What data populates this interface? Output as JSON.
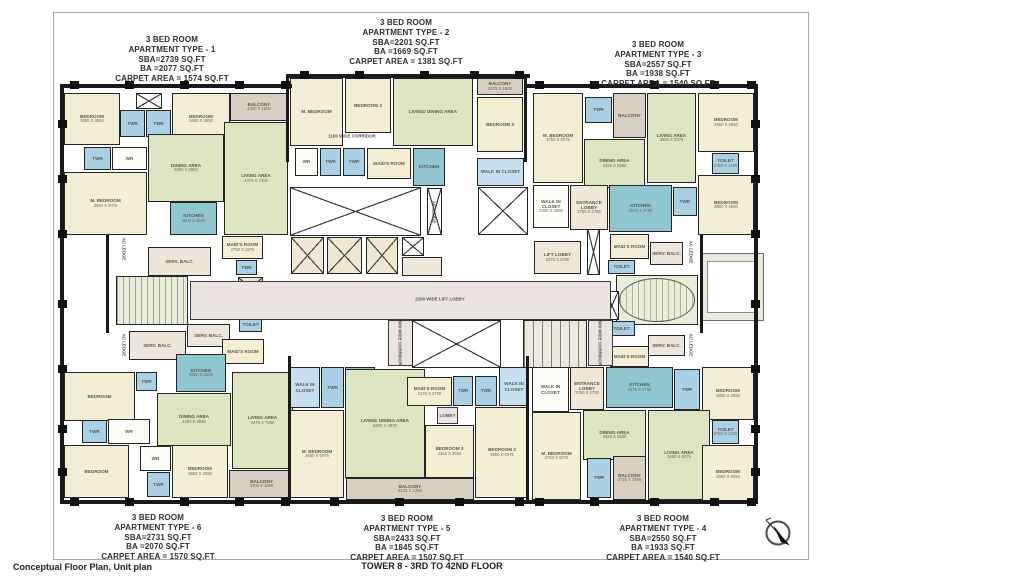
{
  "footer": {
    "left": "Conceptual Floor Plan, Unit plan",
    "center": "TOWER 8 - 3RD  TO 42ND FLOOR"
  },
  "colors": {
    "bedroom": "#f4eed5",
    "living": "#dde4c2",
    "toilet": "#a9d0e5",
    "kitchen": "#8fc6cf",
    "balcony": "#d8cec1",
    "corridor": "#ece4e1",
    "service": "#eee6da",
    "wall": "#1a1a1a"
  },
  "apartments": [
    {
      "id": "type-1",
      "x": 172,
      "y": 35,
      "lines": [
        "3 BED ROOM",
        "APARTMENT TYPE - 1",
        "SBA=2739 SQ.FT",
        "BA =2077 SQ.FT",
        "CARPET AREA = 1574 SQ.FT"
      ]
    },
    {
      "id": "type-2",
      "x": 406,
      "y": 18,
      "lines": [
        "3 BED ROOM",
        "APARTMENT TYPE - 2",
        "SBA=2201 SQ.FT",
        "BA =1669 SQ.FT",
        "CARPET AREA = 1381 SQ.FT"
      ]
    },
    {
      "id": "type-3",
      "x": 658,
      "y": 40,
      "lines": [
        "3 BED ROOM",
        "APARTMENT TYPE - 3",
        "SBA=2557 SQ.FT",
        "BA =1938 SQ.FT",
        "CARPET AREA = 1540 SQ.FT"
      ]
    },
    {
      "id": "type-6",
      "x": 158,
      "y": 513,
      "lines": [
        "3 BED ROOM",
        "APARTMENT TYPE - 6",
        "SBA=2731 SQ.FT",
        "BA =2070 SQ.FT",
        "CARPET AREA = 1570 SQ.FT"
      ]
    },
    {
      "id": "type-5",
      "x": 407,
      "y": 514,
      "lines": [
        "3 BED ROOM",
        "APARTMENT TYPE - 5",
        "SBA=2433 SQ.FT",
        "BA =1845 SQ.FT",
        "CARPET AREA = 1507 SQ.FT"
      ]
    },
    {
      "id": "type-4",
      "x": 663,
      "y": 514,
      "lines": [
        "3 BED ROOM",
        "APARTMENT TYPE - 4",
        "SBA=2550 SQ.FT",
        "BA =1933 SQ.FT",
        "CARPET AREA = 1540 SQ.FT"
      ]
    }
  ],
  "rooms": [
    {
      "type": "bed",
      "label": "BEDROOM",
      "dim": "3650 X 3650",
      "x": 64,
      "y": 93,
      "w": 56,
      "h": 52
    },
    {
      "type": "shaft",
      "x": 136,
      "y": 93,
      "w": 26,
      "h": 16
    },
    {
      "type": "wet",
      "label": "TWR",
      "x": 120,
      "y": 110,
      "w": 25,
      "h": 27
    },
    {
      "type": "wet",
      "label": "TWR",
      "x": 146,
      "y": 110,
      "w": 25,
      "h": 27
    },
    {
      "type": "bed",
      "label": "BEDROOM",
      "dim": "3650 X 3650",
      "x": 172,
      "y": 93,
      "w": 58,
      "h": 52
    },
    {
      "type": "balc",
      "label": "BALCONY",
      "dim": "4400 X 1800",
      "x": 230,
      "y": 93,
      "w": 58,
      "h": 28
    },
    {
      "type": "liv",
      "label": "LIVING AREA",
      "dim": "4475 X 7200",
      "x": 224,
      "y": 122,
      "w": 64,
      "h": 113
    },
    {
      "type": "liv",
      "label": "DINING AREA",
      "dim": "5050 X 2850",
      "x": 148,
      "y": 134,
      "w": 76,
      "h": 68
    },
    {
      "type": "wet",
      "label": "TWR",
      "x": 84,
      "y": 147,
      "w": 27,
      "h": 23
    },
    {
      "type": "wr",
      "label": "WR",
      "x": 112,
      "y": 147,
      "w": 35,
      "h": 23
    },
    {
      "type": "bed",
      "label": "M. BEDROOM",
      "dim": "3650 X 6075",
      "x": 64,
      "y": 172,
      "w": 83,
      "h": 63
    },
    {
      "type": "kit",
      "label": "KITCHEN",
      "dim": "3800 X 3525",
      "x": 170,
      "y": 202,
      "w": 47,
      "h": 33
    },
    {
      "type": "serv",
      "label": "SERV. BALC.",
      "x": 148,
      "y": 247,
      "w": 63,
      "h": 29
    },
    {
      "type": "bed",
      "label": "MAID'S ROOM",
      "dim": "2750 X 1875",
      "x": 222,
      "y": 236,
      "w": 41,
      "h": 23
    },
    {
      "type": "wet",
      "label": "TWR",
      "x": 236,
      "y": 260,
      "w": 21,
      "h": 15
    },
    {
      "type": "stair",
      "x": 116,
      "y": 276,
      "w": 72,
      "h": 49
    },
    {
      "type": "shaft",
      "x": 192,
      "y": 292,
      "w": 25,
      "h": 25
    },
    {
      "type": "lift",
      "x": 238,
      "y": 277,
      "w": 25,
      "h": 23
    },
    {
      "type": "wet",
      "label": "TOILET",
      "x": 239,
      "y": 318,
      "w": 23,
      "h": 14
    },
    {
      "type": "serv",
      "label": "SERV. BALC.",
      "x": 187,
      "y": 324,
      "w": 43,
      "h": 23
    },
    {
      "type": "serv",
      "label": "SERV. BALC.",
      "x": 129,
      "y": 331,
      "w": 57,
      "h": 29
    },
    {
      "type": "bed",
      "label": "MAID'S ROOM",
      "x": 222,
      "y": 339,
      "w": 42,
      "h": 25
    },
    {
      "type": "bed",
      "label": "BEDROOM",
      "x": 64,
      "y": 372,
      "w": 71,
      "h": 49
    },
    {
      "type": "wet",
      "label": "TWR",
      "x": 136,
      "y": 372,
      "w": 21,
      "h": 19
    },
    {
      "type": "kit",
      "label": "KITCHEN",
      "dim": "3800 X 3525",
      "x": 176,
      "y": 354,
      "w": 50,
      "h": 38
    },
    {
      "type": "liv",
      "label": "DINING AREA",
      "dim": "4400 X 2850",
      "x": 157,
      "y": 393,
      "w": 74,
      "h": 53
    },
    {
      "type": "liv",
      "label": "LIVING AREA",
      "dim": "4475 X 7200",
      "x": 232,
      "y": 372,
      "w": 61,
      "h": 97
    },
    {
      "type": "wet",
      "label": "TWR",
      "x": 82,
      "y": 420,
      "w": 25,
      "h": 23
    },
    {
      "type": "wr",
      "label": "WR",
      "x": 108,
      "y": 419,
      "w": 42,
      "h": 25
    },
    {
      "type": "bed",
      "label": "BEDROOM",
      "x": 64,
      "y": 445,
      "w": 65,
      "h": 53
    },
    {
      "type": "wr",
      "label": "WR",
      "x": 140,
      "y": 446,
      "w": 31,
      "h": 25
    },
    {
      "type": "bed",
      "label": "BEDROOM",
      "dim": "3650 X 3650",
      "x": 172,
      "y": 445,
      "w": 56,
      "h": 53
    },
    {
      "type": "wet",
      "label": "TWR",
      "x": 147,
      "y": 472,
      "w": 23,
      "h": 25
    },
    {
      "type": "balc",
      "label": "BALCONY",
      "dim": "4400 X 1800",
      "x": 229,
      "y": 470,
      "w": 65,
      "h": 28
    },
    {
      "type": "bed",
      "label": "M. BEDROOM",
      "x": 290,
      "y": 78,
      "w": 53,
      "h": 68
    },
    {
      "type": "bed",
      "label": "BEDROOM 2",
      "x": 345,
      "y": 78,
      "w": 46,
      "h": 55
    },
    {
      "type": "liv",
      "label": "LIVING/ DINING AREA",
      "x": 393,
      "y": 78,
      "w": 80,
      "h": 68
    },
    {
      "type": "balc",
      "label": "BALCONY",
      "dim": "2075 X 1800",
      "x": 477,
      "y": 78,
      "w": 46,
      "h": 17
    },
    {
      "type": "bed",
      "label": "BEDROOM 3",
      "x": 477,
      "y": 97,
      "w": 46,
      "h": 55
    },
    {
      "type": "wr",
      "label": "WR",
      "x": 295,
      "y": 148,
      "w": 23,
      "h": 28
    },
    {
      "type": "wet",
      "label": "TWR",
      "x": 320,
      "y": 148,
      "w": 21,
      "h": 28
    },
    {
      "type": "wet",
      "label": "TWR",
      "x": 343,
      "y": 148,
      "w": 22,
      "h": 28
    },
    {
      "type": "bed",
      "label": "MAID'S ROOM",
      "x": 367,
      "y": 148,
      "w": 44,
      "h": 31
    },
    {
      "type": "kit",
      "label": "KITCHEN",
      "x": 413,
      "y": 148,
      "w": 32,
      "h": 38
    },
    {
      "type": "wic",
      "label": "WALK IN CLOSET",
      "x": 477,
      "y": 158,
      "w": 47,
      "h": 28
    },
    {
      "type": "bed",
      "label": "M. BEDROOM",
      "dim": "3750 X 6075",
      "x": 533,
      "y": 93,
      "w": 50,
      "h": 90
    },
    {
      "type": "wet",
      "label": "TWR",
      "x": 585,
      "y": 97,
      "w": 27,
      "h": 26
    },
    {
      "type": "balc",
      "label": "BALCONY",
      "x": 613,
      "y": 93,
      "w": 33,
      "h": 45
    },
    {
      "type": "liv",
      "label": "LIVING AREA",
      "dim": "3650 X 6075",
      "x": 647,
      "y": 93,
      "w": 49,
      "h": 90
    },
    {
      "type": "bed",
      "label": "BEDROOM",
      "dim": "3650 X 3650",
      "x": 698,
      "y": 93,
      "w": 56,
      "h": 59
    },
    {
      "type": "liv",
      "label": "DINING AREA",
      "dim": "4025 X 2850",
      "x": 584,
      "y": 139,
      "w": 61,
      "h": 49
    },
    {
      "type": "wet",
      "label": "TOILET",
      "dim": "2750 X 1400",
      "x": 712,
      "y": 153,
      "w": 27,
      "h": 21
    },
    {
      "type": "bed",
      "label": "BEDROOM",
      "dim": "3800 X 3650",
      "x": 698,
      "y": 175,
      "w": 56,
      "h": 60
    },
    {
      "type": "wr",
      "label": "WALK IN CLOSET",
      "dim": "2300 X 3850",
      "x": 533,
      "y": 185,
      "w": 36,
      "h": 43
    },
    {
      "type": "lobby",
      "label": "ENTRANCE LOBBY",
      "dim": "2750 X 2750",
      "x": 570,
      "y": 185,
      "w": 38,
      "h": 45
    },
    {
      "type": "kit",
      "label": "KITCHEN",
      "dim": "4575 X 2750",
      "x": 609,
      "y": 185,
      "w": 63,
      "h": 47
    },
    {
      "type": "wet",
      "label": "TWR",
      "x": 673,
      "y": 187,
      "w": 24,
      "h": 29
    },
    {
      "type": "bed",
      "label": "MAID'S ROOM",
      "x": 610,
      "y": 234,
      "w": 39,
      "h": 25
    },
    {
      "type": "serv",
      "label": "SERV. BALC.",
      "x": 650,
      "y": 242,
      "w": 33,
      "h": 23
    },
    {
      "type": "wet",
      "label": "TOILET",
      "x": 608,
      "y": 260,
      "w": 27,
      "h": 14
    },
    {
      "type": "stair2",
      "x": 616,
      "y": 275,
      "w": 82,
      "h": 50
    },
    {
      "type": "shaft",
      "x": 605,
      "y": 291,
      "w": 14,
      "h": 29
    },
    {
      "type": "wet",
      "label": "TOILET",
      "x": 608,
      "y": 321,
      "w": 27,
      "h": 15
    },
    {
      "type": "serv",
      "label": "SERV. BALC.",
      "x": 648,
      "y": 335,
      "w": 37,
      "h": 21
    },
    {
      "type": "bed",
      "label": "MAID'S ROOM",
      "x": 610,
      "y": 346,
      "w": 39,
      "h": 21
    },
    {
      "type": "terr",
      "x": 700,
      "y": 253,
      "w": 64,
      "h": 68
    },
    {
      "type": "terr-in",
      "x": 707,
      "y": 261,
      "w": 50,
      "h": 52
    },
    {
      "type": "shaft",
      "x": 290,
      "y": 187,
      "w": 131,
      "h": 49
    },
    {
      "type": "shaft",
      "x": 427,
      "y": 188,
      "w": 15,
      "h": 47
    },
    {
      "type": "lift",
      "x": 291,
      "y": 237,
      "w": 33,
      "h": 37
    },
    {
      "type": "lift",
      "x": 327,
      "y": 237,
      "w": 35,
      "h": 37
    },
    {
      "type": "lift",
      "x": 366,
      "y": 237,
      "w": 32,
      "h": 37
    },
    {
      "type": "shaft",
      "x": 402,
      "y": 237,
      "w": 22,
      "h": 19
    },
    {
      "type": "lobby",
      "x": 402,
      "y": 257,
      "w": 40,
      "h": 19
    },
    {
      "type": "shaft",
      "x": 478,
      "y": 187,
      "w": 50,
      "h": 48
    },
    {
      "type": "lobby",
      "label": "LIFT LOBBY",
      "dim": "2075 X 2000",
      "x": 534,
      "y": 241,
      "w": 47,
      "h": 33
    },
    {
      "type": "shaft",
      "x": 587,
      "y": 229,
      "w": 13,
      "h": 46
    },
    {
      "type": "corr",
      "x": 190,
      "y": 281,
      "w": 421,
      "h": 39
    },
    {
      "type": "corr",
      "x": 388,
      "y": 320,
      "w": 25,
      "h": 46
    },
    {
      "type": "corr",
      "x": 588,
      "y": 320,
      "w": 25,
      "h": 46
    },
    {
      "type": "shaft",
      "x": 412,
      "y": 320,
      "w": 89,
      "h": 48
    },
    {
      "type": "duct",
      "x": 523,
      "y": 320,
      "w": 64,
      "h": 48
    },
    {
      "type": "wic",
      "label": "WALK IN CLOSET",
      "x": 290,
      "y": 367,
      "w": 30,
      "h": 41
    },
    {
      "type": "wet",
      "label": "TWR",
      "x": 321,
      "y": 367,
      "w": 23,
      "h": 41
    },
    {
      "type": "kit",
      "label": "KITCHEN",
      "x": 345,
      "y": 367,
      "w": 30,
      "h": 41
    },
    {
      "type": "bed",
      "label": "M. BEDROOM",
      "dim": "3650 X 6075",
      "x": 290,
      "y": 410,
      "w": 54,
      "h": 88
    },
    {
      "type": "liv",
      "label": "LIVING/ DINING AREA",
      "dim": "5800 X 4975",
      "x": 345,
      "y": 369,
      "w": 80,
      "h": 109
    },
    {
      "type": "bed",
      "label": "MAID'S ROOM",
      "dim": "2175 X 2700",
      "x": 407,
      "y": 377,
      "w": 45,
      "h": 29
    },
    {
      "type": "wet",
      "label": "TWR",
      "x": 453,
      "y": 376,
      "w": 20,
      "h": 30
    },
    {
      "type": "wet",
      "label": "TWR",
      "x": 475,
      "y": 376,
      "w": 22,
      "h": 30
    },
    {
      "type": "wic",
      "label": "WALK IN CLOSET",
      "x": 499,
      "y": 367,
      "w": 30,
      "h": 39
    },
    {
      "type": "corr",
      "label": "LOBBY",
      "x": 437,
      "y": 407,
      "w": 21,
      "h": 17
    },
    {
      "type": "bed",
      "label": "BEDROOM 3",
      "dim": "3250 X 3650",
      "x": 425,
      "y": 425,
      "w": 49,
      "h": 53
    },
    {
      "type": "bed",
      "label": "BEDROOM 2",
      "dim": "3650 X 6075",
      "x": 475,
      "y": 407,
      "w": 54,
      "h": 91
    },
    {
      "type": "balc",
      "label": "BALCONY",
      "dim": "6125 X 1200",
      "x": 346,
      "y": 478,
      "w": 128,
      "h": 22
    },
    {
      "type": "wr",
      "label": "WALK IN CLOSET",
      "x": 532,
      "y": 367,
      "w": 37,
      "h": 45
    },
    {
      "type": "lobby",
      "label": "ENTRANCE LOBBY",
      "dim": "2750 X 2700",
      "x": 570,
      "y": 367,
      "w": 34,
      "h": 43
    },
    {
      "type": "kit",
      "label": "KITCHEN",
      "dim": "4575 X 2750",
      "x": 606,
      "y": 367,
      "w": 67,
      "h": 41
    },
    {
      "type": "wet",
      "label": "TWR",
      "x": 674,
      "y": 369,
      "w": 26,
      "h": 41
    },
    {
      "type": "bed",
      "label": "BEDROOM",
      "dim": "3800 X 3650",
      "x": 702,
      "y": 367,
      "w": 52,
      "h": 53
    },
    {
      "type": "bed",
      "label": "M. BEDROOM",
      "dim": "3750 X 6075",
      "x": 532,
      "y": 412,
      "w": 49,
      "h": 88
    },
    {
      "type": "liv",
      "label": "DINING AREA",
      "dim": "4025 X 2850",
      "x": 583,
      "y": 410,
      "w": 63,
      "h": 50
    },
    {
      "type": "liv",
      "label": "LIVING AREA",
      "dim": "3650 X 6075",
      "x": 648,
      "y": 410,
      "w": 62,
      "h": 90
    },
    {
      "type": "wet",
      "label": "TOILET",
      "dim": "2750 X 1400",
      "x": 712,
      "y": 420,
      "w": 27,
      "h": 24
    },
    {
      "type": "bed",
      "label": "BEDROOM",
      "dim": "3650 X 3650",
      "x": 702,
      "y": 445,
      "w": 52,
      "h": 59
    },
    {
      "type": "wet",
      "label": "TWR",
      "x": 587,
      "y": 458,
      "w": 24,
      "h": 40
    },
    {
      "type": "balc",
      "label": "BALCONY",
      "dim": "2725 X 1800",
      "x": 613,
      "y": 456,
      "w": 33,
      "h": 44
    }
  ],
  "plan_labels": [
    {
      "text": "2200 WIDE LIFT LOBBY",
      "x": 440,
      "y": 299,
      "rot": 0
    },
    {
      "text": "1100 WIDE CORRIDOR",
      "x": 352,
      "y": 136,
      "rot": 0
    },
    {
      "text": "1500 WIDE CORRIDOR",
      "x": 400,
      "y": 342,
      "rot": 90
    },
    {
      "text": "1500 WIDE CORRIDOR",
      "x": 600,
      "y": 342,
      "rot": 90
    },
    {
      "text": "AC LEDGE",
      "x": 124,
      "y": 249,
      "rot": 90
    },
    {
      "text": "AC LEDGE",
      "x": 124,
      "y": 345,
      "rot": 90
    },
    {
      "text": "AC LEDGE",
      "x": 691,
      "y": 252,
      "rot": 90
    },
    {
      "text": "AC LEDGE",
      "x": 691,
      "y": 345,
      "rot": 90
    },
    {
      "text": "AC LEDGE",
      "x": 434,
      "y": 212,
      "rot": 90
    }
  ],
  "walls": [
    [
      62,
      84,
      230,
      4
    ],
    [
      286,
      74,
      244,
      4
    ],
    [
      526,
      84,
      232,
      4
    ],
    [
      62,
      500,
      696,
      4
    ],
    [
      60,
      84,
      4,
      420
    ],
    [
      754,
      84,
      4,
      420
    ],
    [
      286,
      78,
      3,
      84
    ],
    [
      524,
      78,
      3,
      84
    ],
    [
      288,
      356,
      3,
      148
    ],
    [
      526,
      356,
      3,
      148
    ],
    [
      106,
      235,
      3,
      98
    ],
    [
      700,
      235,
      3,
      98
    ]
  ],
  "columns": [
    [
      70,
      81
    ],
    [
      125,
      81
    ],
    [
      180,
      81
    ],
    [
      235,
      81
    ],
    [
      281,
      81
    ],
    [
      300,
      71
    ],
    [
      355,
      71
    ],
    [
      420,
      71
    ],
    [
      470,
      71
    ],
    [
      515,
      71
    ],
    [
      535,
      81
    ],
    [
      590,
      81
    ],
    [
      650,
      81
    ],
    [
      710,
      81
    ],
    [
      747,
      81
    ],
    [
      70,
      498
    ],
    [
      125,
      498
    ],
    [
      180,
      498
    ],
    [
      235,
      498
    ],
    [
      281,
      498
    ],
    [
      330,
      498
    ],
    [
      395,
      498
    ],
    [
      455,
      498
    ],
    [
      515,
      498
    ],
    [
      535,
      498
    ],
    [
      590,
      498
    ],
    [
      650,
      498
    ],
    [
      710,
      498
    ],
    [
      747,
      498
    ],
    [
      58,
      120
    ],
    [
      58,
      175
    ],
    [
      58,
      230
    ],
    [
      58,
      300
    ],
    [
      58,
      365
    ],
    [
      58,
      425
    ],
    [
      58,
      468
    ],
    [
      751,
      120
    ],
    [
      751,
      175
    ],
    [
      751,
      230
    ],
    [
      751,
      300
    ],
    [
      751,
      365
    ],
    [
      751,
      425
    ],
    [
      751,
      468
    ]
  ]
}
